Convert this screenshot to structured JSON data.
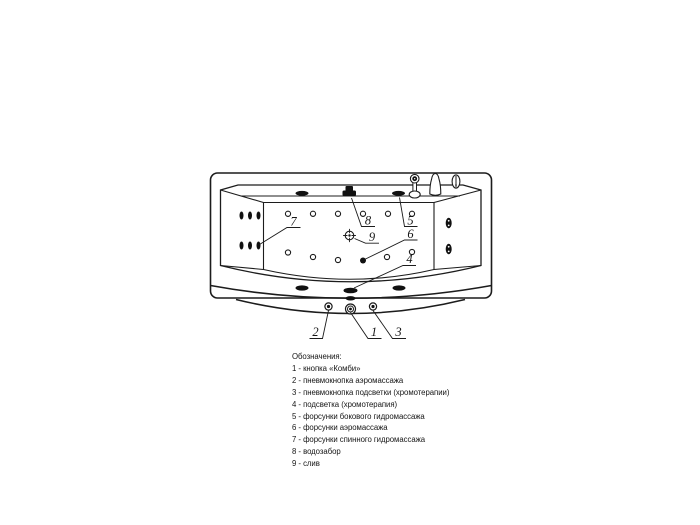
{
  "page": {
    "background": "#ffffff",
    "line_color": "#1c1c1c"
  },
  "diagram": {
    "type": "bathtub-top-view-technical-drawing",
    "labels": [
      "1",
      "2",
      "3",
      "4",
      "5",
      "6",
      "7",
      "8",
      "9"
    ]
  },
  "legend": {
    "title": "Обозначения:",
    "items": [
      "1 - кнопка «Комби»",
      "2 - пневмокнопка аэромассажа",
      "3 - пневмокнопка подсветки (хромотерапии)",
      "4 - подсветка (хромотерапия)",
      "5 - форсунки бокового гидромассажа",
      "6 - форсунки аэромассажа",
      "7 - форсунки спинного гидромассажа",
      "8 - водозабор",
      "9 - слив"
    ]
  }
}
